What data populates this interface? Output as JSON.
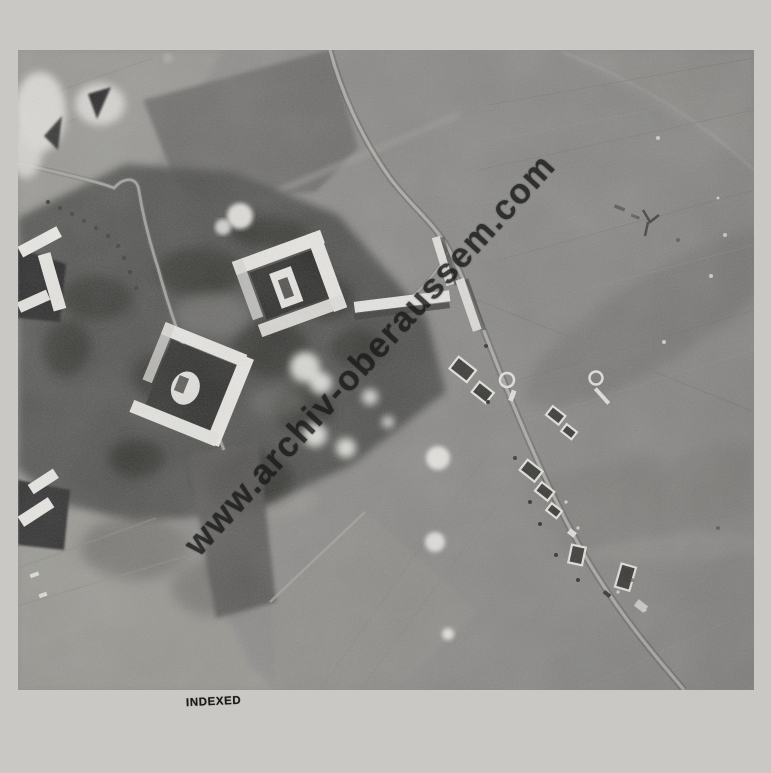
{
  "colors": {
    "page-bg": "#c9c8c4",
    "photo-base": "#8b8a88",
    "watermark": "#1b1b1b",
    "stamp": "#1a1a1a"
  },
  "page": {
    "stamp_text": "INDEXED"
  },
  "photo": {
    "watermark_text": "www.archiv-oberaussem.com"
  }
}
